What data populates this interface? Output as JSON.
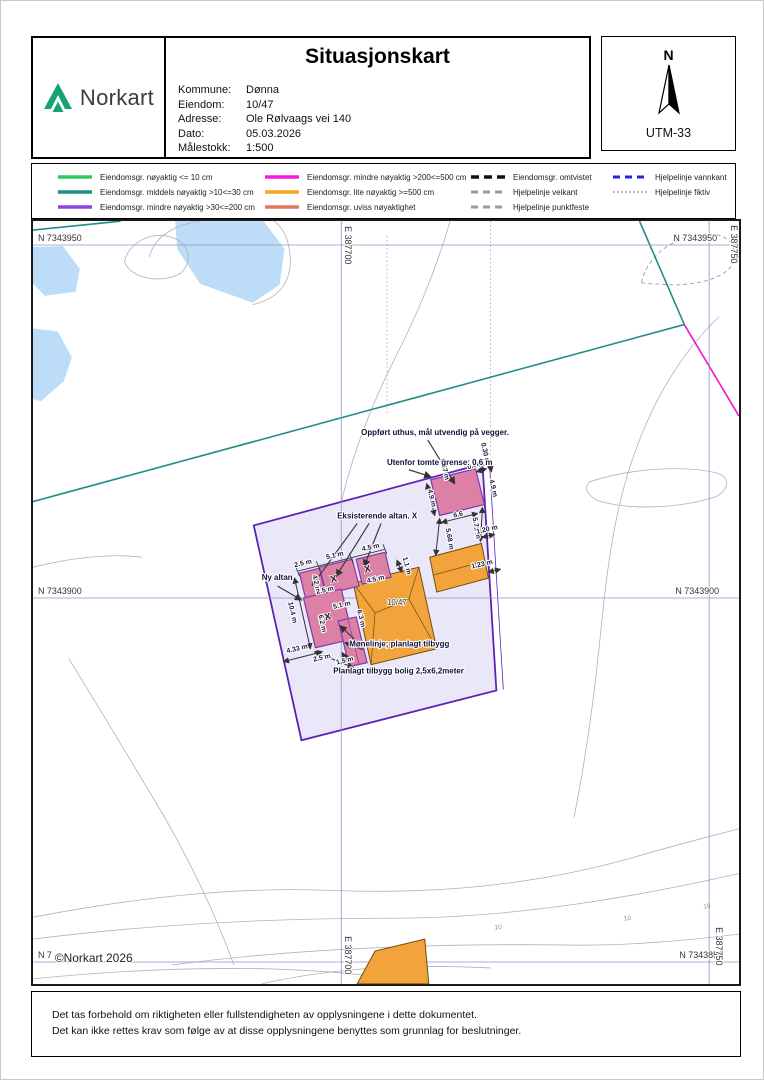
{
  "header": {
    "brand": "Norkart",
    "title": "Situasjonskart",
    "fields": [
      {
        "label": "Kommune:",
        "value": "Dønna"
      },
      {
        "label": "Eiendom:",
        "value": "10/47"
      },
      {
        "label": "Adresse:",
        "value": "Ole Rølvaags vei 140"
      },
      {
        "label": "Dato:",
        "value": "05.03.2026"
      },
      {
        "label": "Målestokk:",
        "value": "1:500"
      }
    ],
    "north_letter": "N",
    "projection": "UTM-33"
  },
  "legend": {
    "items": [
      {
        "label": "Eiendomsgr. nøyaktig <= 10 cm",
        "color": "#2ecc5e",
        "style": "solid"
      },
      {
        "label": "Eiendomsgr. middels nøyaktig >10<=30 cm",
        "color": "#1f8f85",
        "style": "solid"
      },
      {
        "label": "Eiendomsgr. mindre nøyaktig >30<=200 cm",
        "color": "#8b46e0",
        "style": "solid"
      },
      {
        "label": "Eiendomsgr. mindre nøyaktig >200<=500 cm",
        "color": "#f21ddc",
        "style": "solid"
      },
      {
        "label": "Eiendomsgr. lite nøyaktig >=500 cm",
        "color": "#f7a61f",
        "style": "solid"
      },
      {
        "label": "Eiendomsgr. uviss nøyaktighet",
        "color": "#e0775f",
        "style": "solid"
      },
      {
        "label": "Eiendomsgr. omtvistet",
        "color": "#111111",
        "style": "dashed"
      },
      {
        "label": "Hjelpelinje veikant",
        "color": "#9a9a9a",
        "style": "dashed"
      },
      {
        "label": "Hjelpelinje punktfeste",
        "color": "#9a9a9a",
        "style": "dashed"
      },
      {
        "label": "Hjelpelinje vannkant",
        "color": "#2323e6",
        "style": "dashed"
      },
      {
        "label": "Hjelpelinje fiktiv",
        "color": "#aaaaaa",
        "style": "dotted"
      }
    ]
  },
  "map": {
    "grid": {
      "n": [
        "N 7343950",
        "N 7343900",
        "N 7343850"
      ],
      "n_partial": "N 7",
      "e": [
        "E 387700",
        "E 387750"
      ]
    },
    "copyright": "©Norkart 2026",
    "parcel_number": "10/47",
    "x_mark": "X",
    "elev_label": "10",
    "dims": [
      "2.5 m",
      "5.1 m",
      "4.5 m",
      "1.1 m",
      "4.5 m",
      "4.2 m",
      "2.5 m",
      "10.4 m",
      "5.1 m",
      "6.2 m",
      "6.3 m",
      "4.33 m",
      "2.5 m",
      "1,5 m",
      "0.67 m",
      "4.9 m",
      "0.43 m",
      "0.30 m",
      "4.9 m",
      "6.6",
      "5.68 m",
      "5.71 m",
      "1.20 m",
      "1.23 m"
    ],
    "annotations": [
      "Oppført uthus, mål utvendig på vegger.",
      "Utenfor tomte grense: 0,6 m",
      "Eksisterende altan. X",
      "Ny altan",
      "Mønelinje; planlagt tilbygg",
      "Planlagt tilbygg bolig 2,5x6,2meter"
    ]
  },
  "footer": {
    "line1": "Det tas forbehold om riktigheten eller fullstendigheten av opplysningene i dette dokumentet.",
    "line2": "Det kan ikke rettes krav som følge av at disse opplysningene benyttes som grunnlag for beslutninger."
  },
  "colors": {
    "water": "#bcdcf7",
    "contour": "#b2b2b8",
    "gridline": "#9191c8",
    "teal": "#1f8f85",
    "magenta": "#ee16c8",
    "parcel_fill": "#eae8f8",
    "parcel_stroke": "#5b21b6",
    "building_pink": "#dc80a6",
    "building_pink_stroke": "#7c3aad",
    "building_orange": "#f2a33b",
    "building_orange_stroke": "#6b4e12",
    "dot_gray": "#ababab",
    "dash_gray": "#a5a5a5",
    "logo_green": "#16a374"
  }
}
